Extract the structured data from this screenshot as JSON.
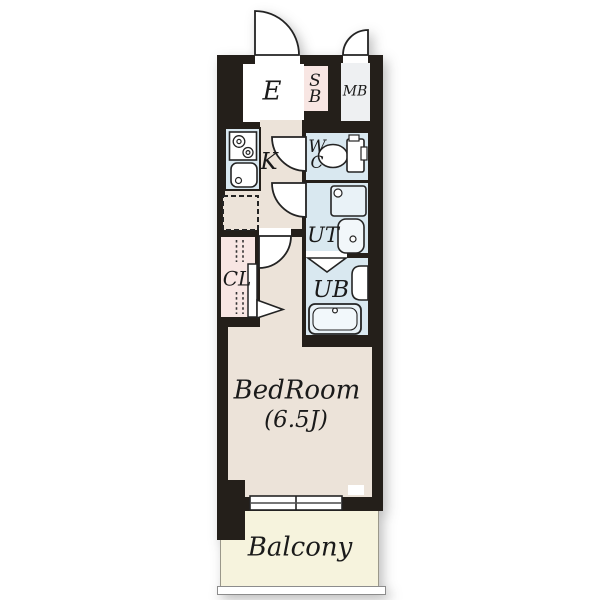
{
  "floorplan": {
    "type": "apartment-floor-plan",
    "labels": {
      "entrance": "E",
      "shoe_box": "S\nB",
      "meter_box": "MB",
      "kitchen": "K",
      "water_closet": "W\nC",
      "utility": "UT",
      "unit_bath": "UB",
      "closet": "CL",
      "bedroom_name": "BedRoom",
      "bedroom_size": "(6.5J)",
      "balcony": "Balcony"
    },
    "colors": {
      "wall": "#241f1a",
      "floor_beige": "#ece3d9",
      "wet_area_blue": "#d9e8f0",
      "storage_pink": "#f8e6e3",
      "meter_box_gray": "#eef0f2",
      "balcony_yellow": "#f6f3dd",
      "white": "#ffffff"
    }
  }
}
